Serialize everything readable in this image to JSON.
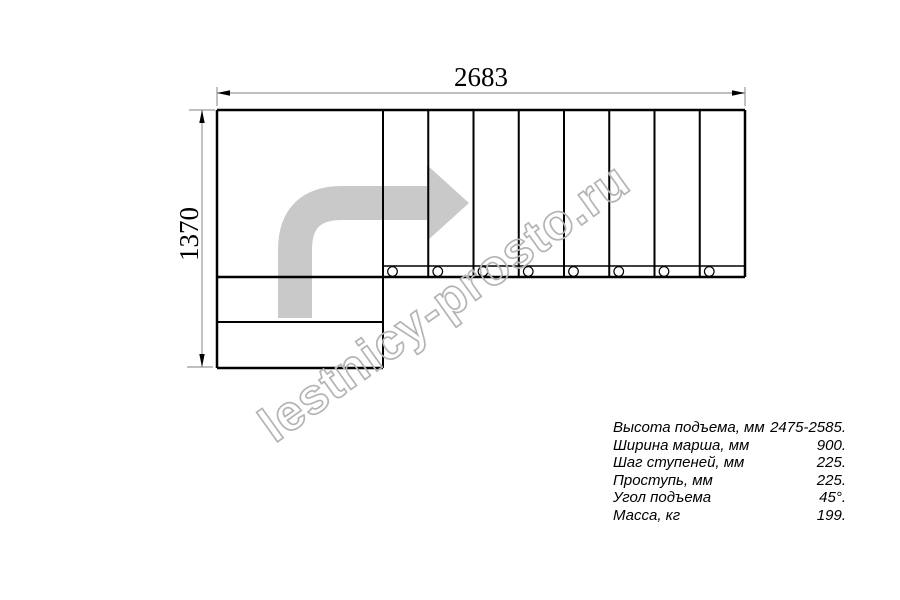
{
  "watermark": {
    "text": "lestnicy-prosto.ru",
    "color": "#b4b4b4"
  },
  "drawing": {
    "width_label": "2683",
    "height_label": "1370",
    "treads_count": 8,
    "line_color": "#000000",
    "dim_line_color": "#999999",
    "arrow_color": "#c9c9c9"
  },
  "specs": {
    "rows": [
      {
        "label": "Высота подъема, мм",
        "value": "2475-2585."
      },
      {
        "label": "Ширина марша, мм",
        "value": "900."
      },
      {
        "label": "Шаг ступеней, мм",
        "value": "225."
      },
      {
        "label": "Проступь, мм",
        "value": "225."
      },
      {
        "label": "Угол подъема",
        "value": "45°."
      },
      {
        "label": "Масса, кг",
        "value": "199."
      }
    ]
  }
}
